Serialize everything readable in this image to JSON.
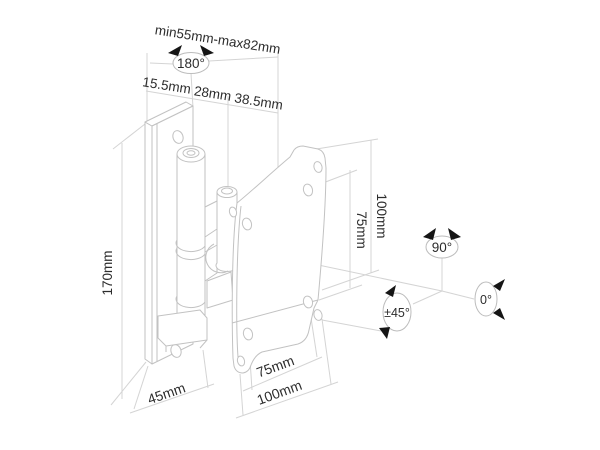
{
  "diagram": {
    "colors": {
      "background": "#ffffff",
      "drawing_line": "#c2c2c2",
      "dimension_line": "#d4d4d4",
      "text": "#2d2d2d",
      "arrowhead": "#151515"
    },
    "dimensions": {
      "width_range": "min55mm-max82mm",
      "depth_segments": [
        "15.5mm",
        "28mm",
        "38.5mm"
      ],
      "bracket_height": "170mm",
      "vesa_vertical_outer": "100mm",
      "vesa_vertical_inner": "75mm",
      "base_depth": "45mm",
      "vesa_horizontal_inner": "75mm",
      "vesa_horizontal_outer": "100mm"
    },
    "angles": {
      "swivel": "180°",
      "pivot_vertical": "90°",
      "tilt": "±45°",
      "rest": "0°"
    }
  }
}
